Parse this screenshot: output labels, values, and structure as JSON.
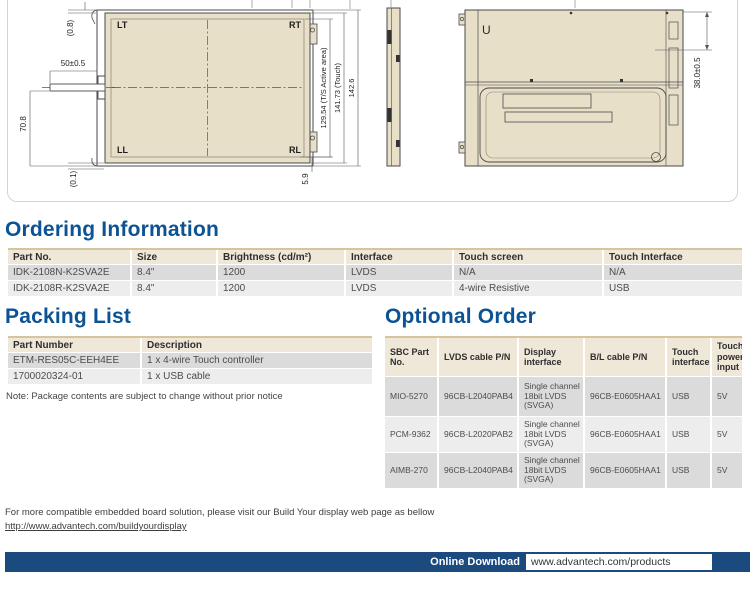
{
  "colors": {
    "accent_blue": "#0b5394",
    "bar_blue": "#1b4a7f",
    "drawing_beige": "#e8dfc9",
    "table_header_beige": "#efe8d8",
    "row_gray_dark": "#dbdbdb",
    "row_gray_light": "#ededed"
  },
  "drawing": {
    "front_view": {
      "corner_labels": {
        "lt": "LT",
        "rt": "RT",
        "ll": "LL",
        "rl": "RL"
      },
      "dims": {
        "top_gap": "(0.8)",
        "tail_width": "50±0.5",
        "tail_height": "70.8",
        "bottom_gap": "(0.1)",
        "bottom_offset": "5.9",
        "active_area": "129.54 (T/S Active area)",
        "touch": "141.73 (Touch)",
        "overall": "142.6"
      }
    },
    "back_view": {
      "u_label": "U",
      "depth_dim": "38.0±0.5"
    }
  },
  "ordering": {
    "title": "Ordering Information",
    "headers": [
      "Part No.",
      "Size",
      "Brightness (cd/m²)",
      "Interface",
      "Touch screen",
      "Touch Interface"
    ],
    "rows": [
      [
        "IDK-2108N-K2SVA2E",
        "8.4\"",
        "1200",
        "LVDS",
        "N/A",
        "N/A"
      ],
      [
        "IDK-2108R-K2SVA2E",
        "8.4\"",
        "1200",
        "LVDS",
        "4-wire Resistive",
        "USB"
      ]
    ]
  },
  "packing": {
    "title": "Packing List",
    "headers": [
      "Part Number",
      "Description"
    ],
    "rows": [
      [
        "ETM-RES05C-EEH4EE",
        "1 x 4-wire Touch controller"
      ],
      [
        "1700020324-01",
        "1 x USB cable"
      ]
    ],
    "note": "Note: Package contents are subject to change without prior notice"
  },
  "optional": {
    "title": "Optional Order",
    "headers": [
      "SBC Part No.",
      "LVDS cable P/N",
      "Display interface",
      "B/L cable P/N",
      "Touch interface",
      "Touch power input"
    ],
    "rows": [
      [
        "MIO-5270",
        "96CB-L2040PAB4",
        "Single channel 18bit LVDS (SVGA)",
        "96CB-E0605HAA1",
        "USB",
        "5V"
      ],
      [
        "PCM-9362",
        "96CB-L2020PAB2",
        "Single channel 18bit LVDS (SVGA)",
        "96CB-E0605HAA1",
        "USB",
        "5V"
      ],
      [
        "AIMB-270",
        "96CB-L2040PAB4",
        "Single channel 18bit LVDS (SVGA)",
        "96CB-E0605HAA1",
        "USB",
        "5V"
      ]
    ]
  },
  "footer": {
    "line1": "For more compatible embedded board solution, please visit our Build Your display web page as bellow",
    "link": "http://www.advantech.com/buildyourdisplay",
    "download_label": "Online Download",
    "download_url": "www.advantech.com/products"
  }
}
